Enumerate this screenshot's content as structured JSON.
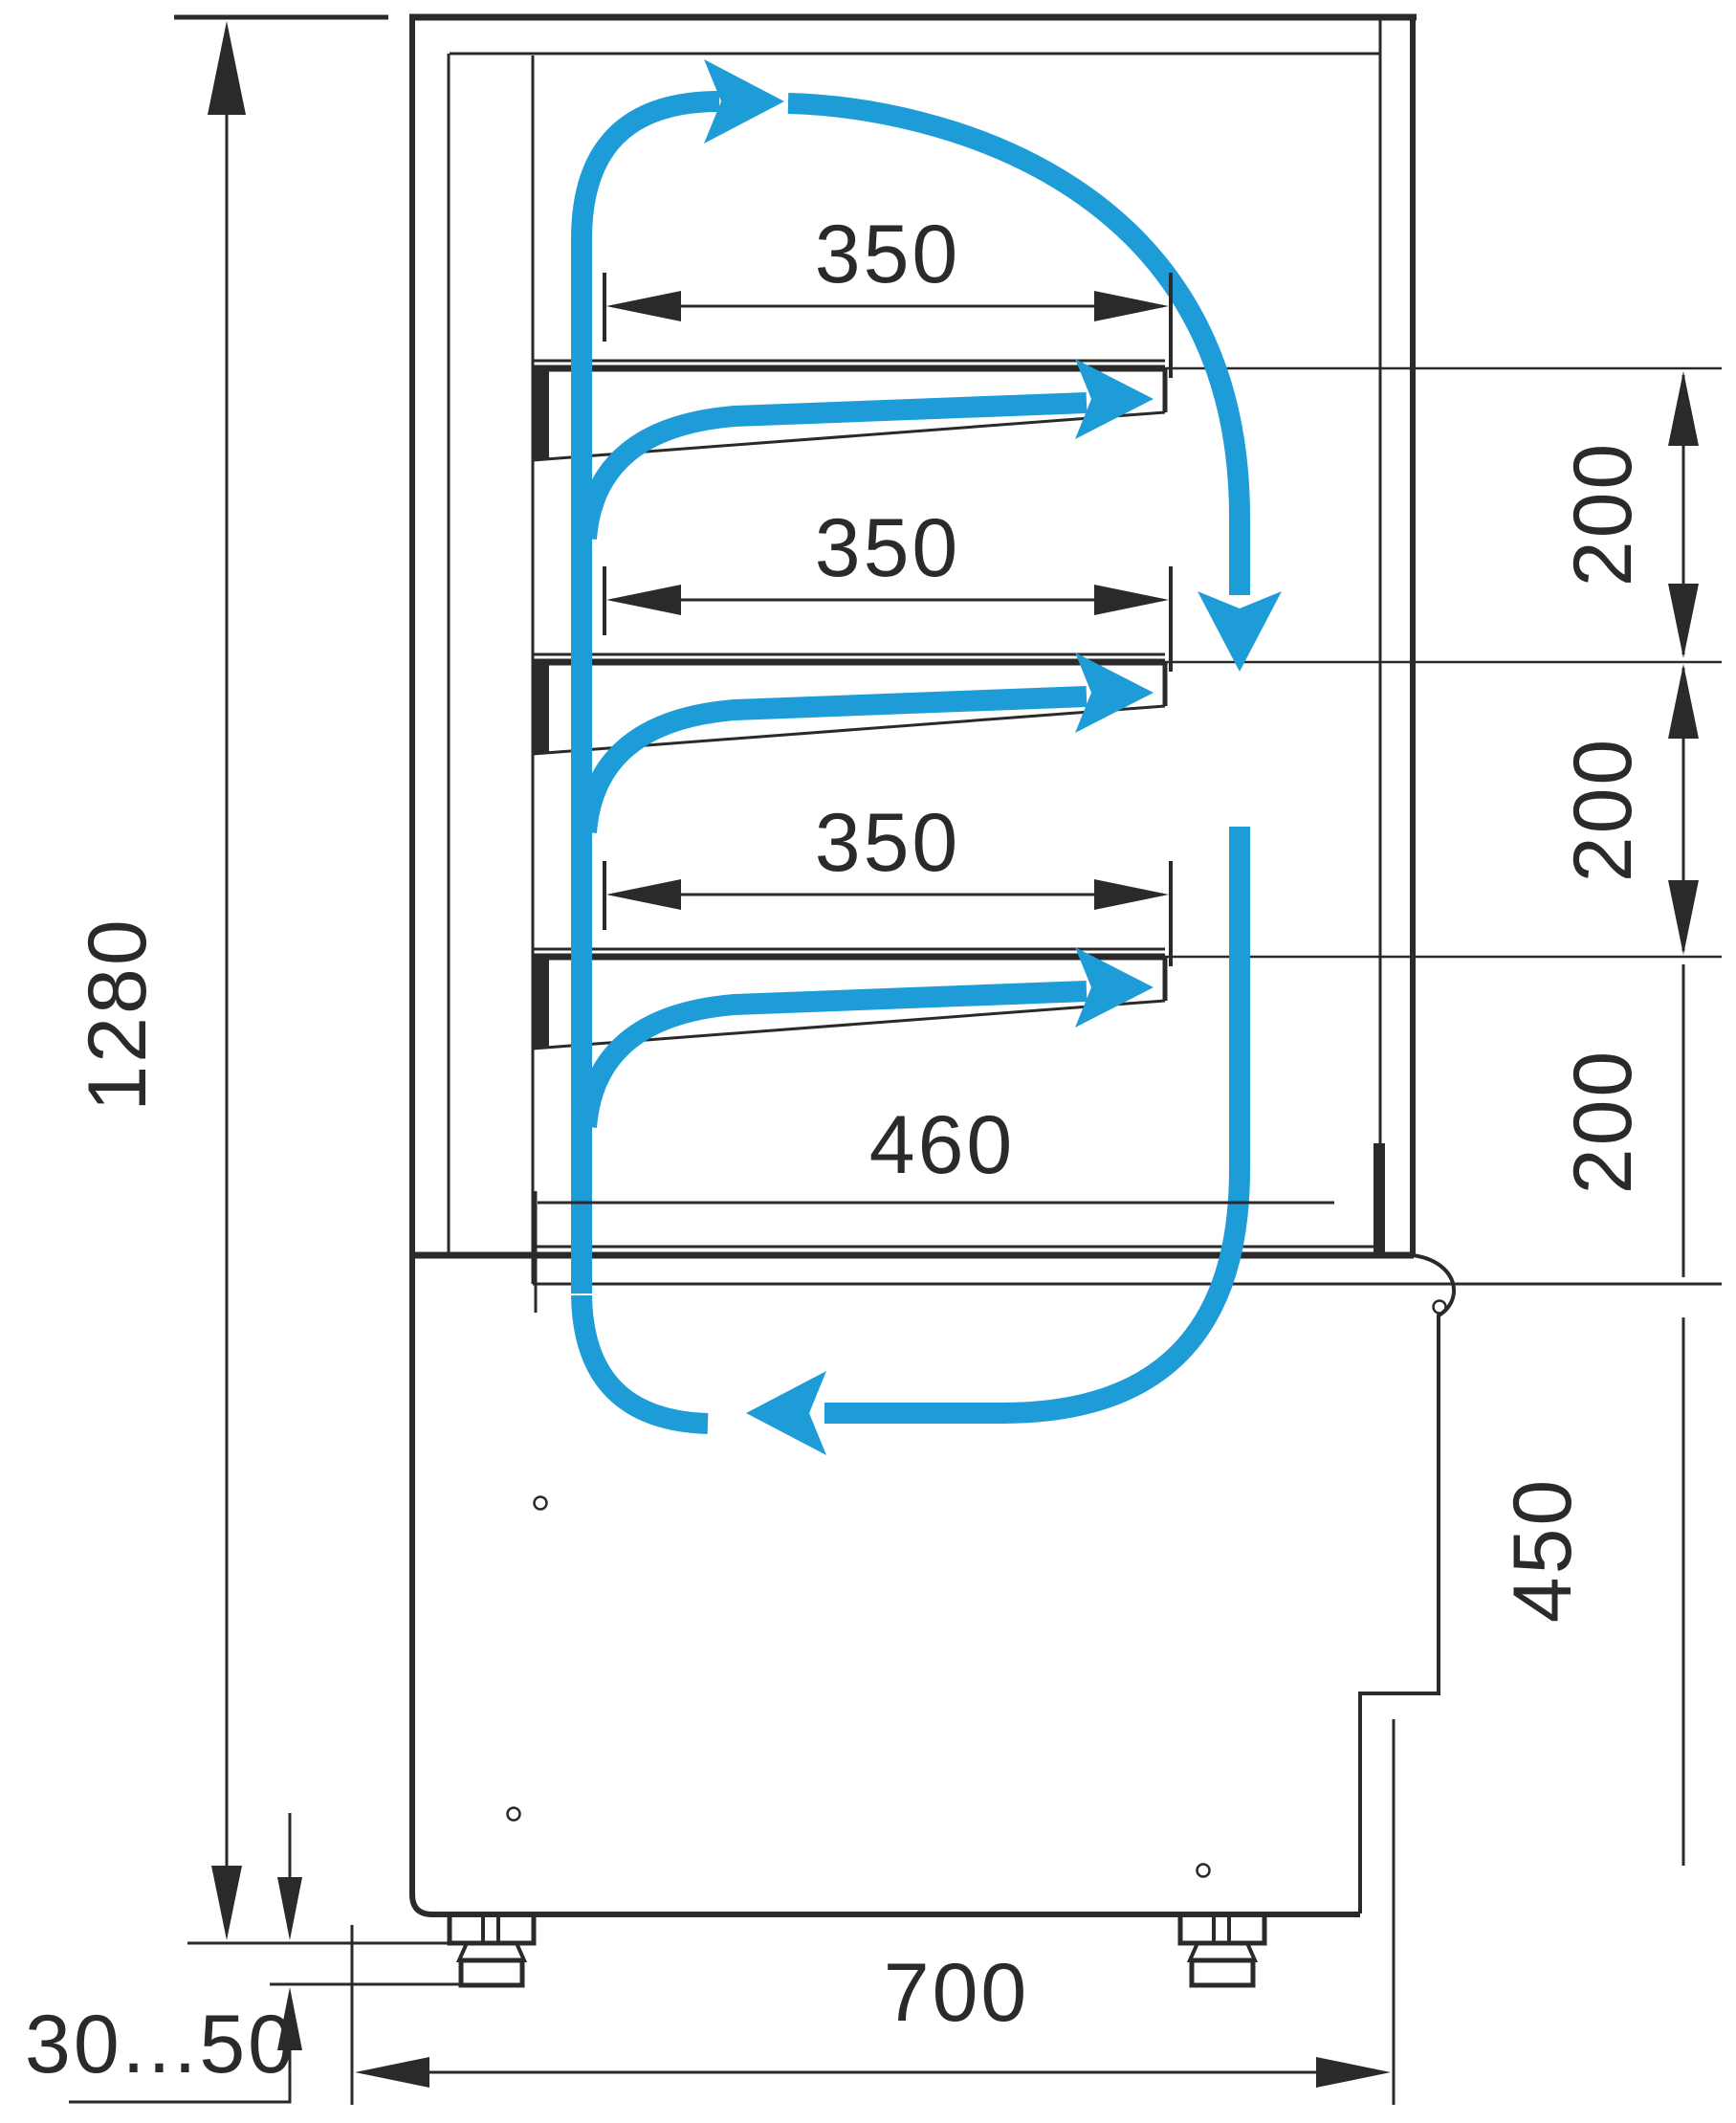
{
  "drawing": {
    "kind": "refrigerated-display-case-side-section",
    "colors": {
      "line": "#2B2A29",
      "airflow": "#1E9CD8",
      "background": "#FFFFFF"
    },
    "labels": {
      "shelf1_width": "350",
      "shelf2_width": "350",
      "shelf3_width": "350",
      "bottom_shelf_width": "460",
      "gap1": "200",
      "gap2": "200",
      "gap3": "200",
      "overall_height": "1280",
      "base_height": "450",
      "base_depth": "700",
      "foot_height_range": "30...50"
    },
    "airflow_icons": [
      "air-up-back-duct-arrow-icon",
      "air-top-right-arrow-icon",
      "air-down-front-arrow-icon",
      "air-return-left-arrow-icon",
      "air-shelf1-arrow-icon",
      "air-shelf2-arrow-icon",
      "air-shelf3-arrow-icon"
    ]
  }
}
